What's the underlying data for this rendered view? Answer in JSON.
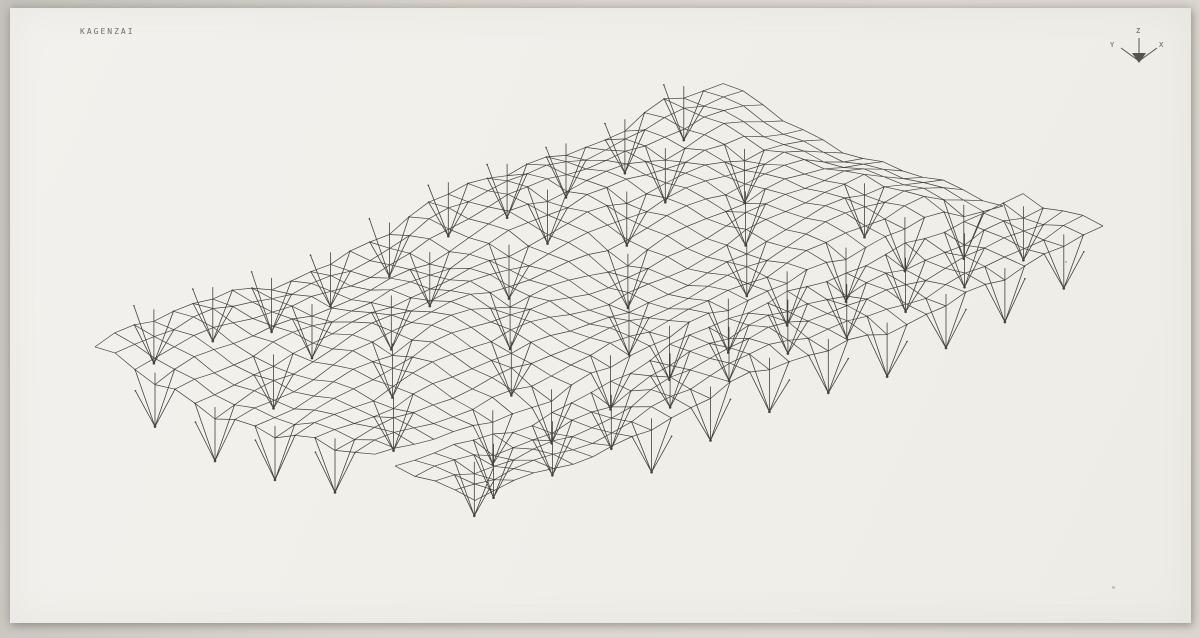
{
  "photo": {
    "backdrop_color": "#d9d5ce",
    "paper_color": "#f1efea",
    "ink_color": "#45433e"
  },
  "header": {
    "title": "KAGENZAI"
  },
  "axis_indicator": {
    "z_label": "Z",
    "y_label": "Y",
    "x_label": "X",
    "color": "#55534e",
    "origin": [
      1139,
      61
    ],
    "z_end": [
      1139,
      38
    ],
    "y_end": [
      1121,
      48
    ],
    "x_end": [
      1157,
      48
    ],
    "arrow": [
      [
        1132,
        53
      ],
      [
        1146,
        53
      ],
      [
        1139,
        63
      ]
    ]
  },
  "drawing": {
    "description": "Axonometric wireframe plot of an undulating space-frame roof surface carried on inverted-pyramid supports, split lengthwise by a narrow diagonal slit into a main panel and a south strip",
    "line_color": "#45433e",
    "line_width": 0.7,
    "support_line_width": 0.8,
    "grid": {
      "cols": 32,
      "rows": 19,
      "origin": [
        95,
        353
      ],
      "u_step": [
        19.625,
        -8.6875
      ],
      "v_step": [
        20,
        7.895
      ]
    },
    "panels": [
      {
        "name": "main-roof-panel",
        "v_from": 0,
        "v_to": 14
      },
      {
        "name": "south-strip-panel",
        "v_from": 15,
        "v_to": 19
      }
    ],
    "wave": {
      "a1": 7,
      "f1": 0.4,
      "p1": 0.9,
      "g1": 0.35,
      "q1": 0.3,
      "a2": 5,
      "f2": 0.22,
      "g2": 0.55,
      "p2": 1.3,
      "a3": 2.5,
      "f3": 1.15,
      "g3": 1.9,
      "a4": 0.55,
      "f4": 0.45,
      "p4": 2.2
    },
    "fold": {
      "u_start": 29,
      "v_max": 14,
      "drop": 7
    },
    "supports": {
      "depth": 42,
      "mast_above": 12,
      "dip": 6,
      "positions": [
        [
          3,
          0
        ],
        [
          6,
          0
        ],
        [
          9,
          0
        ],
        [
          12,
          0
        ],
        [
          15,
          0
        ],
        [
          18,
          0
        ],
        [
          21,
          0
        ],
        [
          24,
          0
        ],
        [
          27,
          0
        ],
        [
          30,
          0
        ],
        [
          0,
          3
        ],
        [
          0,
          6
        ],
        [
          0,
          9
        ],
        [
          0,
          12
        ],
        [
          8,
          3
        ],
        [
          14,
          3
        ],
        [
          20,
          3
        ],
        [
          26,
          3
        ],
        [
          4,
          5
        ],
        [
          10,
          5
        ],
        [
          16,
          5
        ],
        [
          22,
          5
        ],
        [
          28,
          5
        ],
        [
          7,
          8
        ],
        [
          13,
          8
        ],
        [
          19,
          8
        ],
        [
          25,
          8
        ],
        [
          4,
          11
        ],
        [
          10,
          11
        ],
        [
          16,
          11
        ],
        [
          22,
          11
        ],
        [
          28,
          11
        ],
        [
          6,
          14
        ],
        [
          9,
          14
        ],
        [
          12,
          14
        ],
        [
          15,
          14
        ],
        [
          18,
          14
        ],
        [
          21,
          14
        ],
        [
          24,
          14
        ],
        [
          27,
          14
        ],
        [
          30,
          14
        ],
        [
          2,
          17
        ],
        [
          4,
          16
        ],
        [
          7,
          16
        ],
        [
          10,
          16
        ],
        [
          13,
          16
        ],
        [
          16,
          16
        ],
        [
          19,
          16
        ],
        [
          22,
          16
        ],
        [
          25,
          16
        ],
        [
          28,
          16
        ],
        [
          31,
          16
        ],
        [
          9,
          19
        ],
        [
          12,
          19
        ],
        [
          15,
          19
        ],
        [
          18,
          19
        ],
        [
          21,
          19
        ],
        [
          24,
          19
        ],
        [
          27,
          19
        ],
        [
          30,
          19
        ]
      ]
    }
  }
}
